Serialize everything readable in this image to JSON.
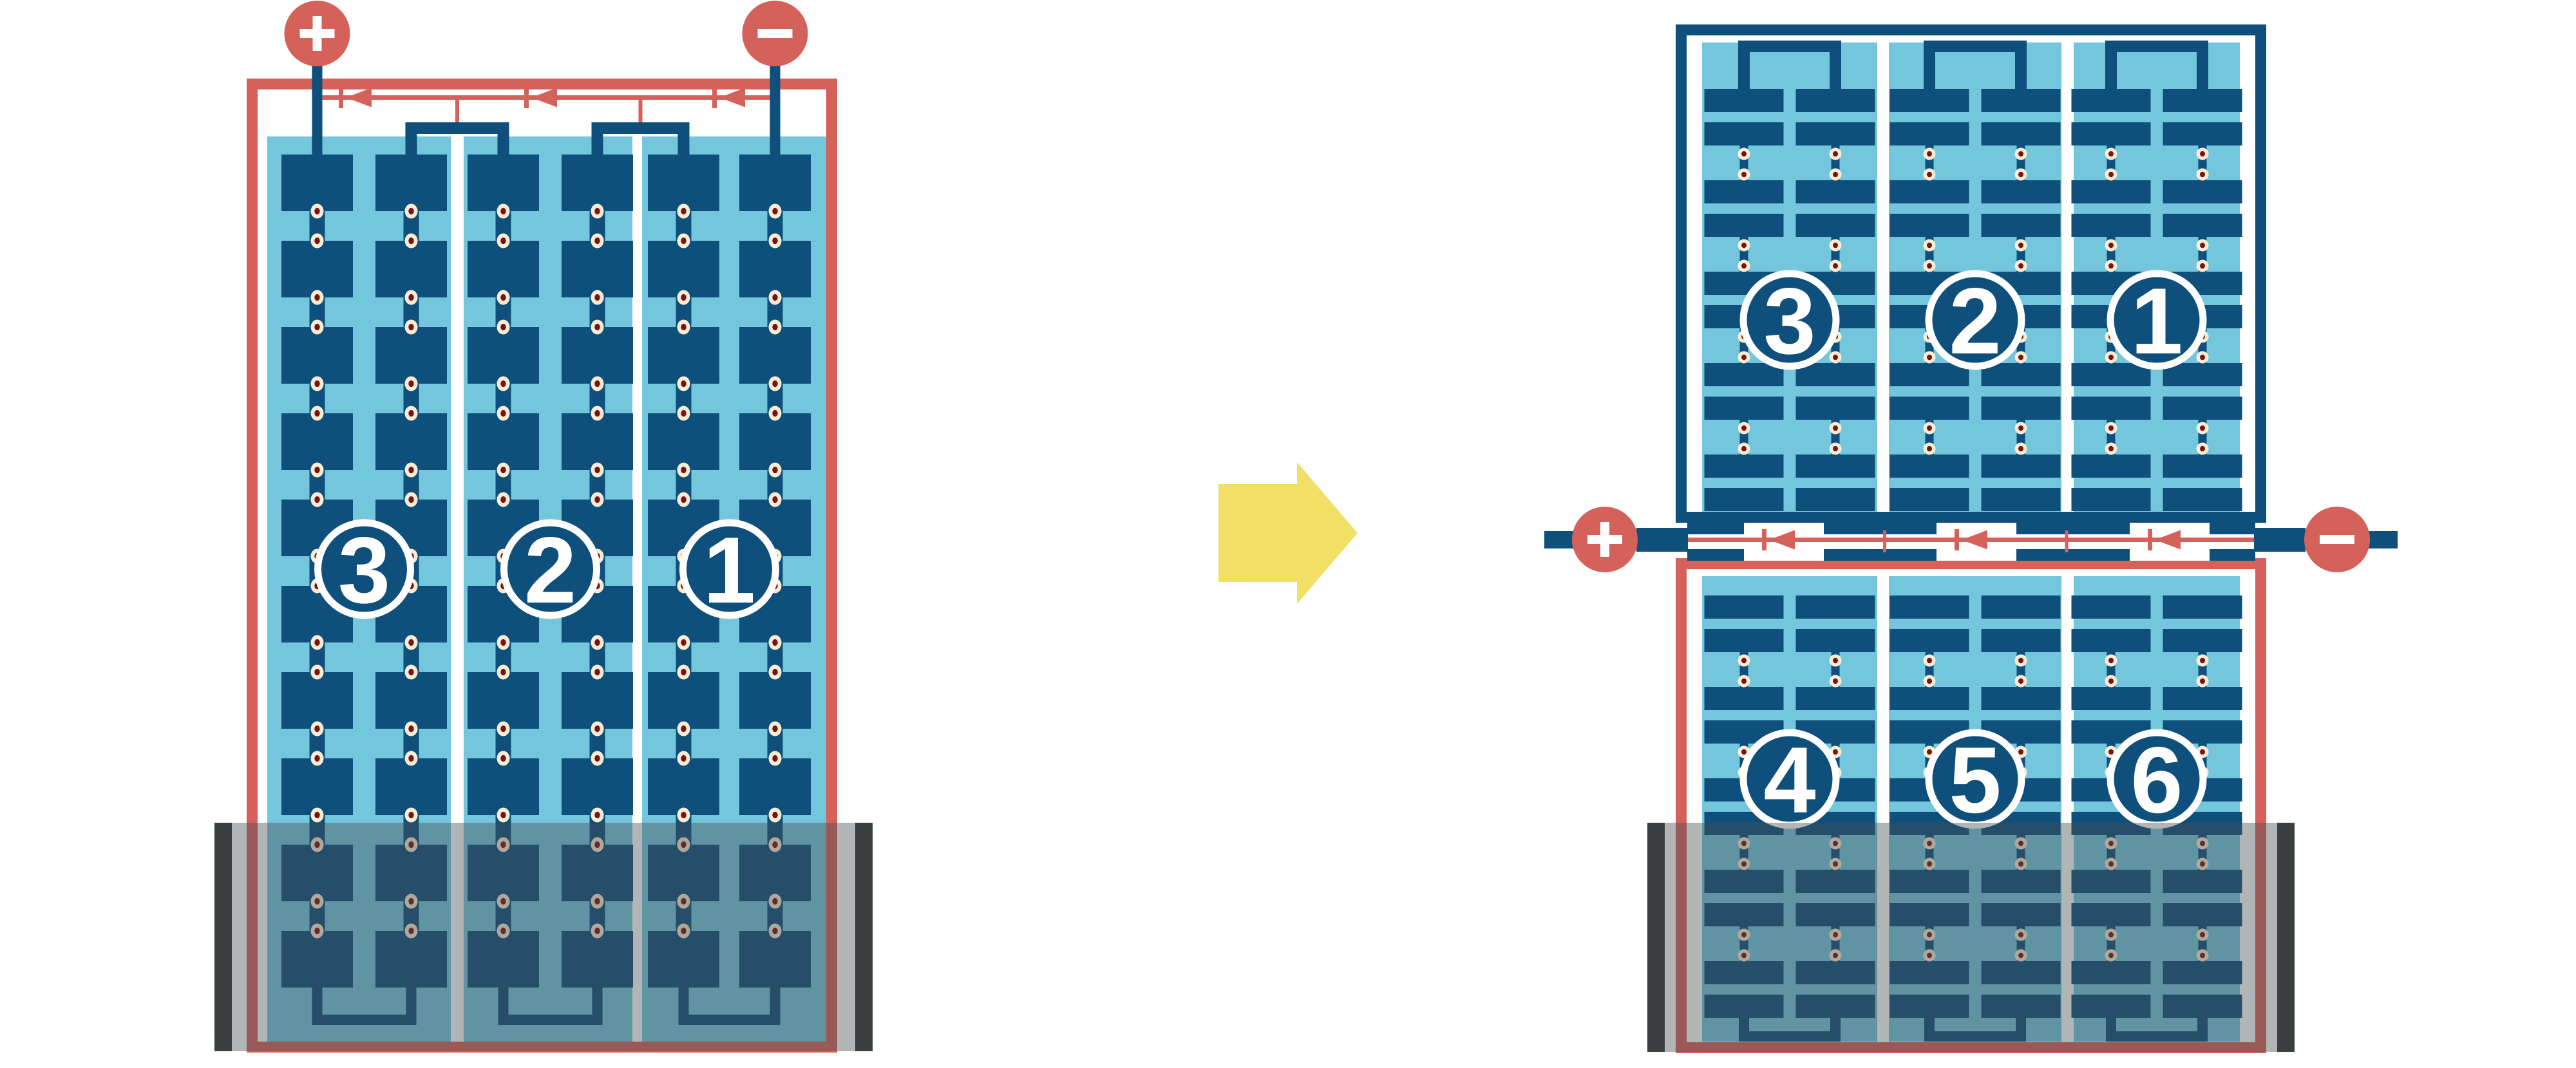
{
  "diagram": {
    "title": "battery-cell-series-reconfiguration",
    "colors": {
      "red": "#D5615B",
      "dark_blue": "#0E4F7C",
      "light_blue": "#74C6DC",
      "cream": "#F7EDD2",
      "dot_red": "#7C1117",
      "yellow": "#F1DF66",
      "white": "#FFFFFF",
      "tank_gray": "rgba(72,78,80,0.42)",
      "tank_bar_dark": "#3B3F40"
    },
    "left_assembly": {
      "name": "single-stack-battery",
      "positive_label": "+",
      "negative_label": "−",
      "cell_groups": [
        "3",
        "2",
        "1"
      ],
      "cell_columns": 3,
      "cell_rows": 10,
      "diode_count": 3
    },
    "transform_arrow": {
      "direction": "right"
    },
    "right_assembly": {
      "name": "split-stack-battery",
      "positive_label": "+",
      "negative_label": "−",
      "top_unit": {
        "cell_groups": [
          "3",
          "2",
          "1"
        ],
        "cell_row_pairs": 5
      },
      "bottom_unit": {
        "cell_groups": [
          "4",
          "5",
          "6"
        ],
        "cell_row_pairs": 5
      },
      "diode_count": 3
    }
  }
}
